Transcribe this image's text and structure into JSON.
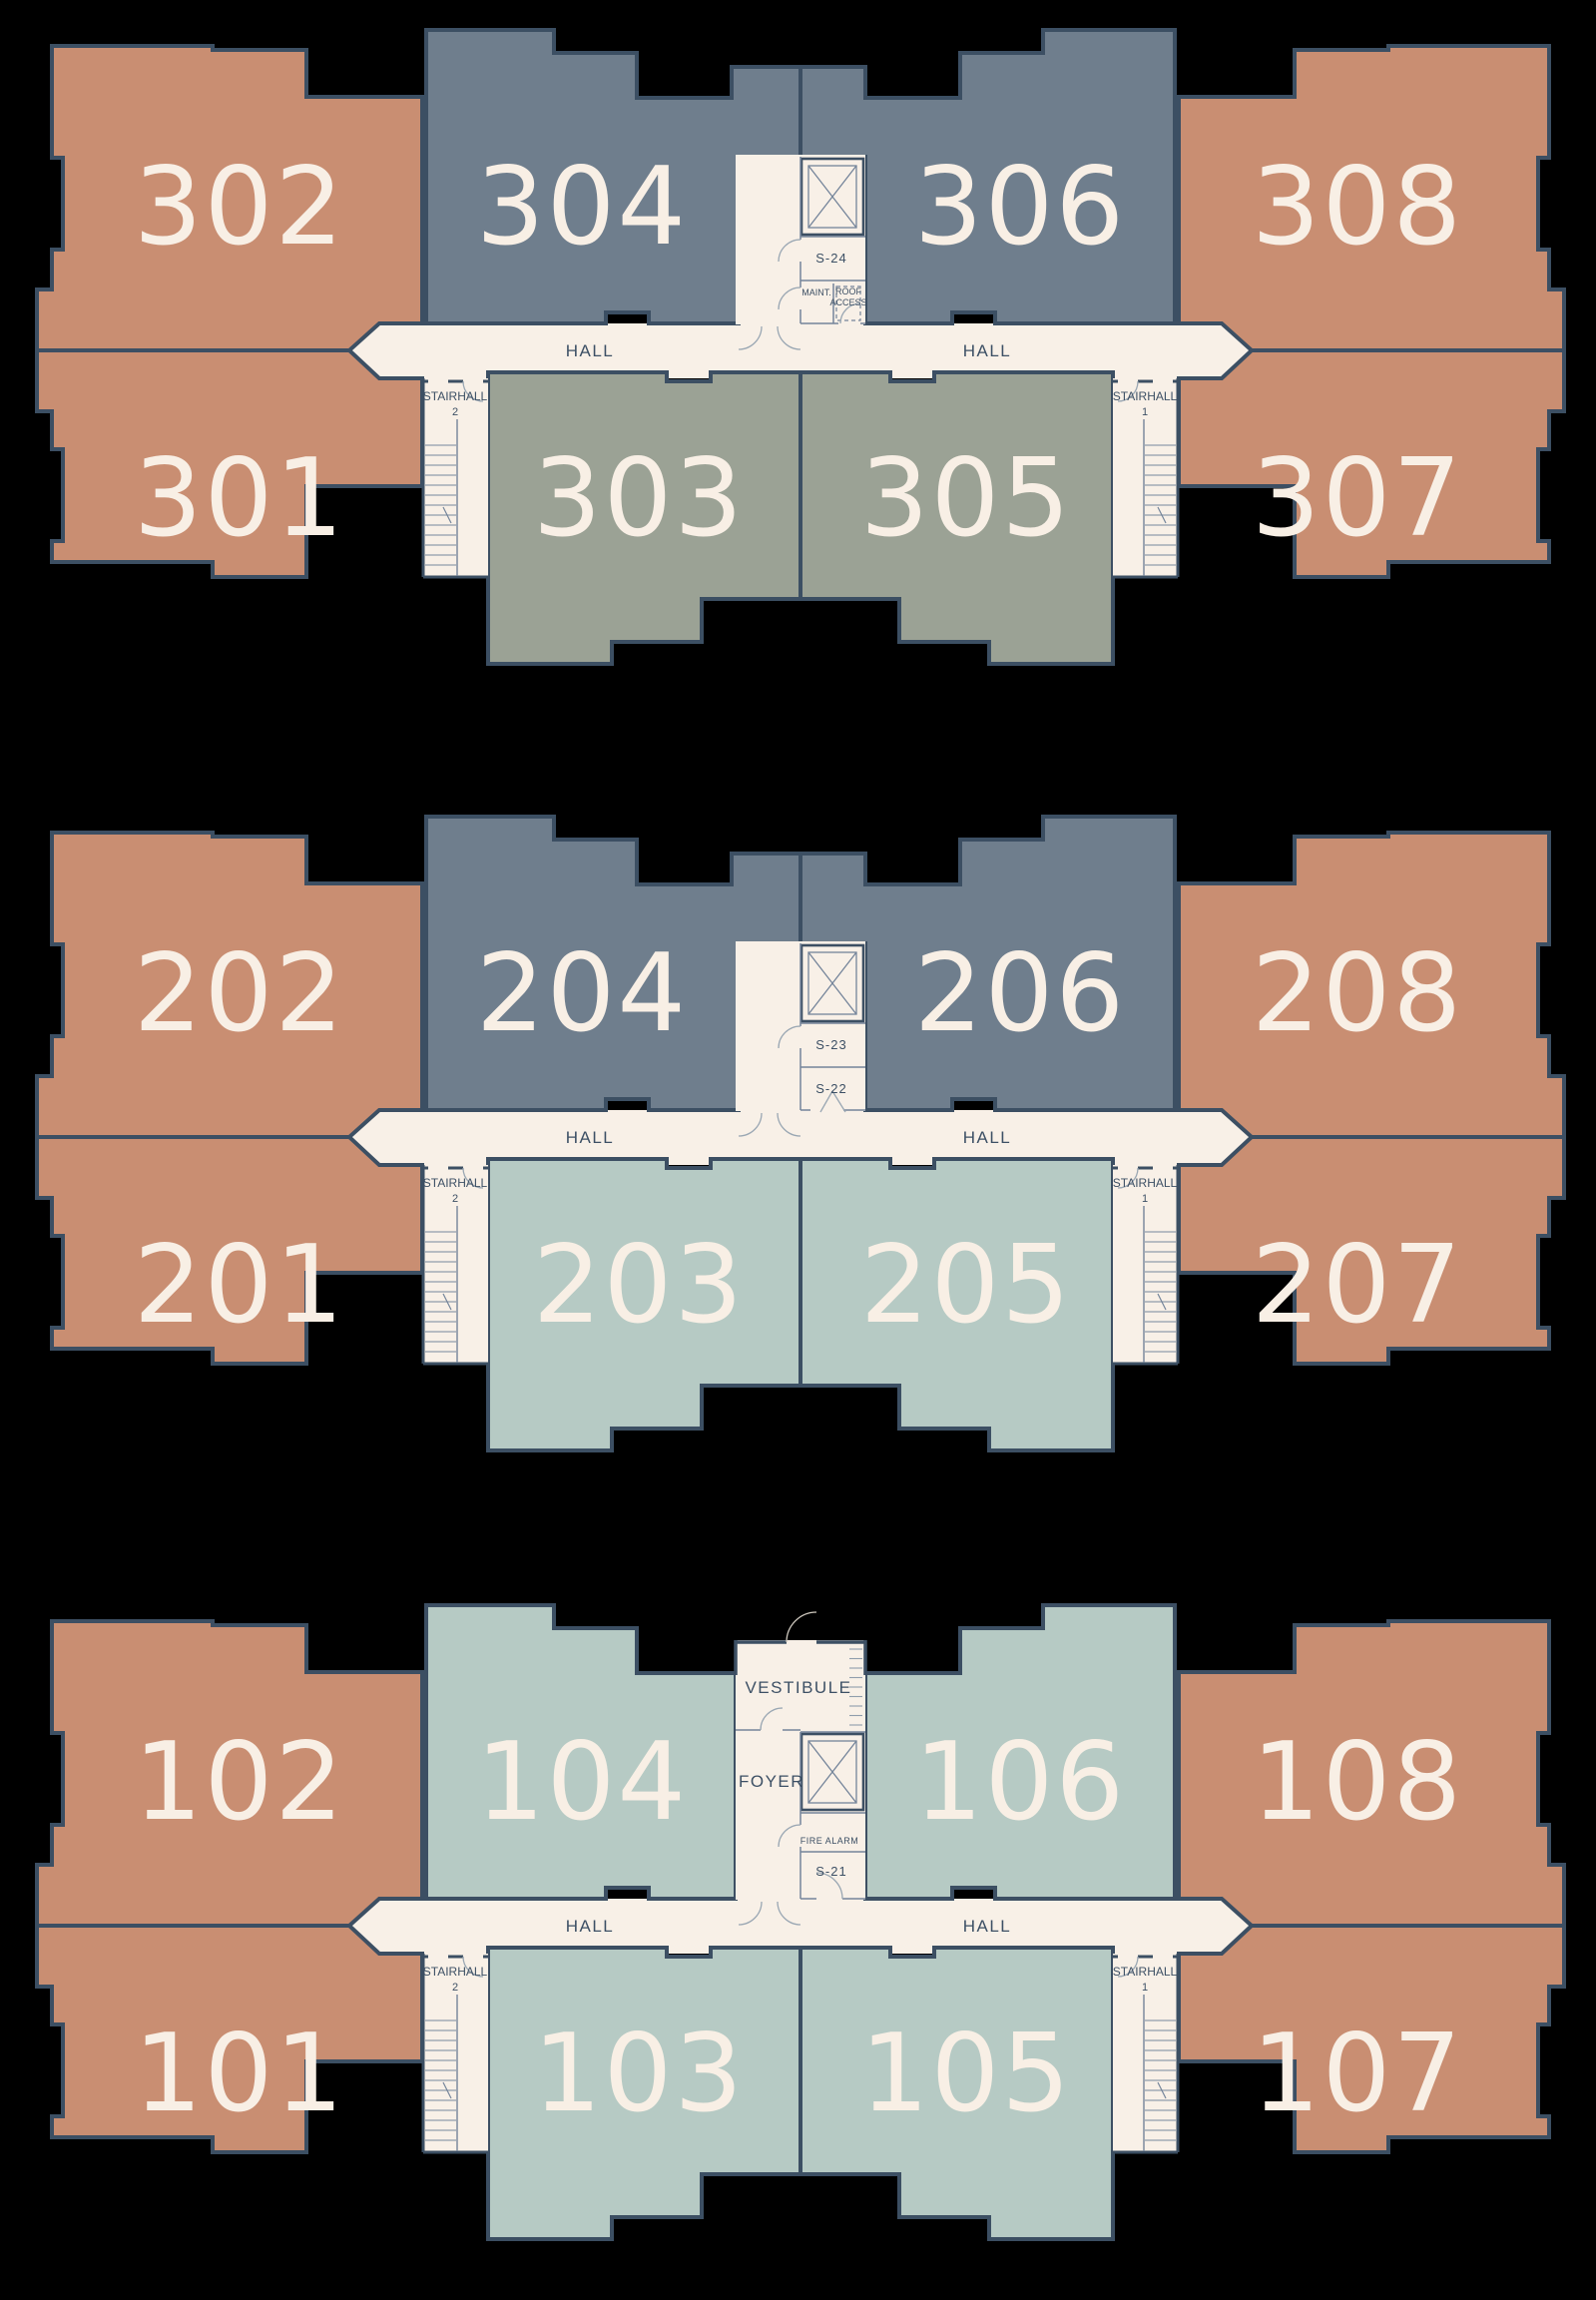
{
  "palette": {
    "background": "#000000",
    "wall": "#3c4f63",
    "hall_floor": "#f8f0e7",
    "salmon": "#c98e72",
    "slate": "#6f7e8d",
    "olive": "#9ba295",
    "sage": "#b6cac4",
    "unit_label": "#f8efe5",
    "annotation": "#3d5065",
    "thin_line": "#74849a",
    "stair_line": "#909dac",
    "arc_line": "#9aa7b3",
    "outside_arc": "#cfc9bf"
  },
  "floors": [
    {
      "name": "Floor 3",
      "units": [
        {
          "id": "302",
          "position": "TLO",
          "color": "salmon"
        },
        {
          "id": "304",
          "position": "TLM",
          "color": "slate"
        },
        {
          "id": "306",
          "position": "TRM",
          "color": "slate"
        },
        {
          "id": "308",
          "position": "TRO",
          "color": "salmon"
        },
        {
          "id": "301",
          "position": "BLO",
          "color": "salmon"
        },
        {
          "id": "303",
          "position": "BLM",
          "color": "olive"
        },
        {
          "id": "305",
          "position": "BRM",
          "color": "olive"
        },
        {
          "id": "307",
          "position": "BRO",
          "color": "salmon"
        }
      ],
      "hall_left": "HALL",
      "hall_right": "HALL",
      "stairhall_left": {
        "line1": "STAIRHALL",
        "line2": "2"
      },
      "stairhall_right": {
        "line1": "STAIRHALL",
        "line2": "1"
      },
      "core": {
        "variant": "floor3",
        "stair_room": "S-24",
        "maint": "MAINT.",
        "roof_line1": "ROOF",
        "roof_line2": "ACCESS"
      }
    },
    {
      "name": "Floor 2",
      "units": [
        {
          "id": "202",
          "position": "TLO",
          "color": "salmon"
        },
        {
          "id": "204",
          "position": "TLM",
          "color": "slate"
        },
        {
          "id": "206",
          "position": "TRM",
          "color": "slate"
        },
        {
          "id": "208",
          "position": "TRO",
          "color": "salmon"
        },
        {
          "id": "201",
          "position": "BLO",
          "color": "salmon"
        },
        {
          "id": "203",
          "position": "BLM",
          "color": "sage"
        },
        {
          "id": "205",
          "position": "BRM",
          "color": "sage"
        },
        {
          "id": "207",
          "position": "BRO",
          "color": "salmon"
        }
      ],
      "hall_left": "HALL",
      "hall_right": "HALL",
      "stairhall_left": {
        "line1": "STAIRHALL",
        "line2": "2"
      },
      "stairhall_right": {
        "line1": "STAIRHALL",
        "line2": "1"
      },
      "core": {
        "variant": "floor2",
        "stair_room": "S-23",
        "stair_room2": "S-22"
      }
    },
    {
      "name": "Floor 1",
      "units": [
        {
          "id": "102",
          "position": "TLO",
          "color": "salmon"
        },
        {
          "id": "104",
          "position": "TLM",
          "color": "sage"
        },
        {
          "id": "106",
          "position": "TRM",
          "color": "sage"
        },
        {
          "id": "108",
          "position": "TRO",
          "color": "salmon"
        },
        {
          "id": "101",
          "position": "BLO",
          "color": "salmon"
        },
        {
          "id": "103",
          "position": "BLM",
          "color": "sage"
        },
        {
          "id": "105",
          "position": "BRM",
          "color": "sage"
        },
        {
          "id": "107",
          "position": "BRO",
          "color": "salmon"
        }
      ],
      "hall_left": "HALL",
      "hall_right": "HALL",
      "stairhall_left": {
        "line1": "STAIRHALL",
        "line2": "2"
      },
      "stairhall_right": {
        "line1": "STAIRHALL",
        "line2": "1"
      },
      "core": {
        "variant": "floor1",
        "vestibule": "VESTIBULE",
        "foyer": "FOYER",
        "fire_alarm": "FIRE ALARM",
        "stair_room": "S-21"
      }
    }
  ]
}
